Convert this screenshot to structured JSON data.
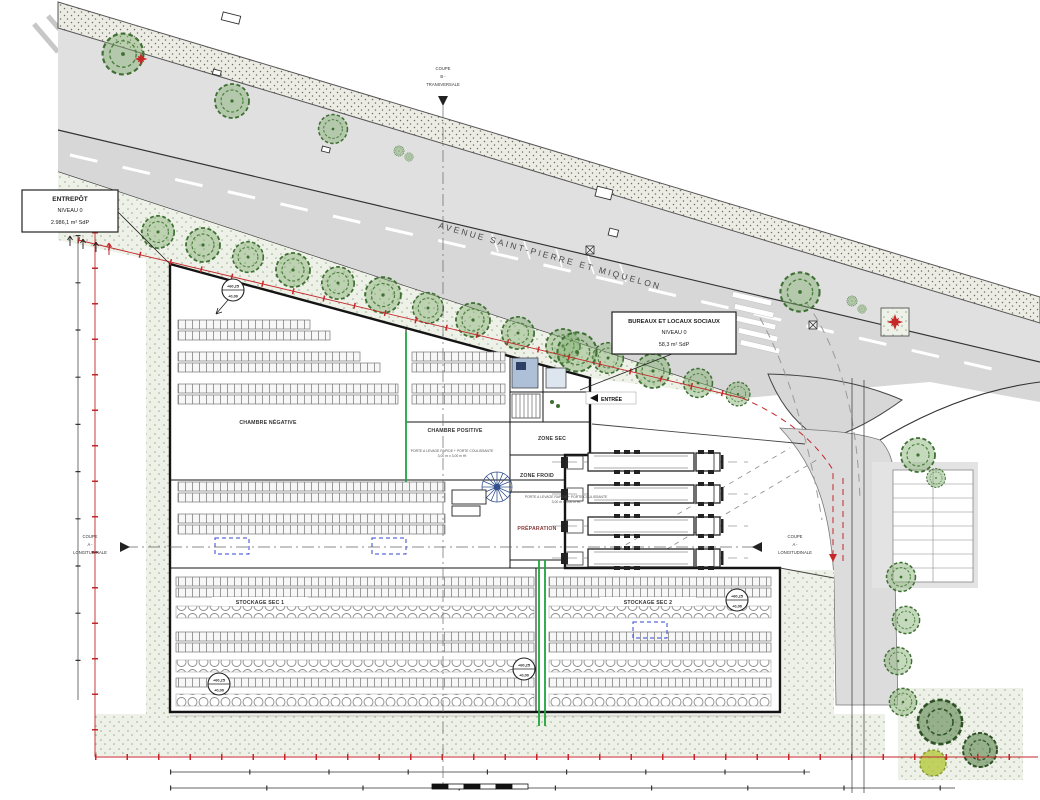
{
  "boxes": {
    "entrepot": {
      "l1": "ENTREPÔT",
      "l2": "NIVEAU 0",
      "l3": "2.986,1 m² SdP"
    },
    "bureaux": {
      "l1": "BUREAUX ET LOCAUX SOCIAUX",
      "l2": "NIVEAU 0",
      "l3": "58,3 m² SdP"
    }
  },
  "street": {
    "name": "AVENUE SAINT-PIERRE ET MIQUELON"
  },
  "sections": {
    "cut_word": "COUPE",
    "b_id": "B -",
    "b_type": "TRANSVERSALE",
    "a_id": "A -",
    "a_type": "LONGITUDINALE"
  },
  "rooms": {
    "chambre_negative": "CHAMBRE NÉGATIVE",
    "chambre_positive": "CHAMBRE POSITIVE",
    "zone_sec": "ZONE SEC",
    "zone_froid": "ZONE FROID",
    "preparation": "PRÉPARATION",
    "stockage_sec_1": "STOCKAGE SEC 1",
    "stockage_sec_2": "STOCKAGE SEC 2"
  },
  "markers": {
    "entree": "ENTRÉE",
    "level_top": "+60,25",
    "level_bottom": "+0,00"
  },
  "annotations": {
    "door_note": "PORTE A LEVAGE RAPIDE + PORTE COULISSANTE",
    "door_size": "3,00 m x 3,00 m Ht"
  },
  "colors": {
    "road": "#d7d7d7",
    "sidewalk": "#e0e0e0",
    "planted": "#eef1e7",
    "tree_stroke": "#3e6f33",
    "boundary_red": "#c4262a",
    "equipment_blue": "#3344cc",
    "fire_wall_green": "#1fa53c",
    "wall": "#141414"
  }
}
